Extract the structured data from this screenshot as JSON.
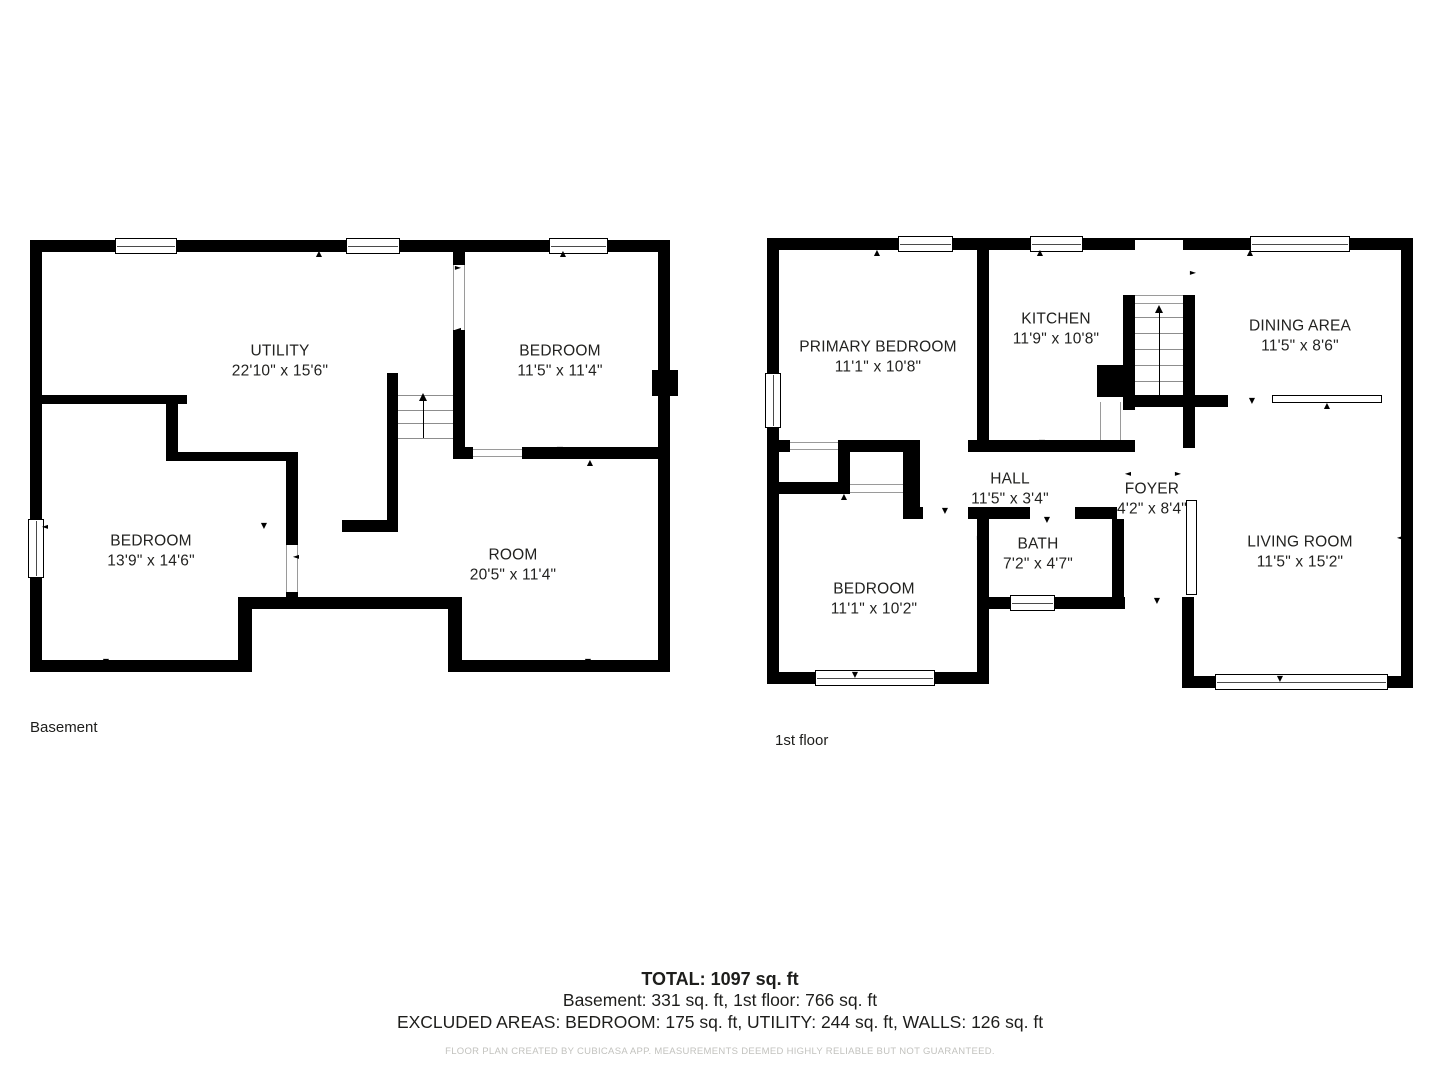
{
  "icons": {
    "up": "▲",
    "down": "▼",
    "left": "◄",
    "right": "►"
  },
  "basement": {
    "floor_label": "Basement",
    "rooms": [
      {
        "name": "UTILITY",
        "dims": "22'10\" x 15'6\""
      },
      {
        "name": "BEDROOM",
        "dims": "11'5\" x 11'4\""
      },
      {
        "name": "BEDROOM",
        "dims": "13'9\" x 14'6\""
      },
      {
        "name": "ROOM",
        "dims": "20'5\" x 11'4\""
      }
    ]
  },
  "first_floor": {
    "floor_label": "1st floor",
    "rooms": [
      {
        "name": "PRIMARY BEDROOM",
        "dims": "11'1\" x 10'8\""
      },
      {
        "name": "KITCHEN",
        "dims": "11'9\" x 10'8\""
      },
      {
        "name": "DINING AREA",
        "dims": "11'5\" x 8'6\""
      },
      {
        "name": "HALL",
        "dims": "11'5\" x 3'4\""
      },
      {
        "name": "FOYER",
        "dims": "4'2\" x 8'4\""
      },
      {
        "name": "BATH",
        "dims": "7'2\" x 4'7\""
      },
      {
        "name": "BEDROOM",
        "dims": "11'1\" x 10'2\""
      },
      {
        "name": "LIVING ROOM",
        "dims": "11'5\" x 15'2\""
      }
    ]
  },
  "summary": {
    "total": "TOTAL: 1097 sq. ft",
    "breakdown": "Basement: 331 sq. ft, 1st floor: 766 sq. ft",
    "excluded": "EXCLUDED AREAS: BEDROOM: 175 sq. ft, UTILITY: 244 sq. ft, WALLS: 126 sq. ft",
    "disclaimer": "FLOOR PLAN CREATED BY CUBICASA APP. MEASUREMENTS DEEMED HIGHLY RELIABLE BUT NOT GUARANTEED."
  },
  "colors": {
    "wall": "#000000",
    "background": "#ffffff",
    "thin_line": "#9a9a9a"
  }
}
